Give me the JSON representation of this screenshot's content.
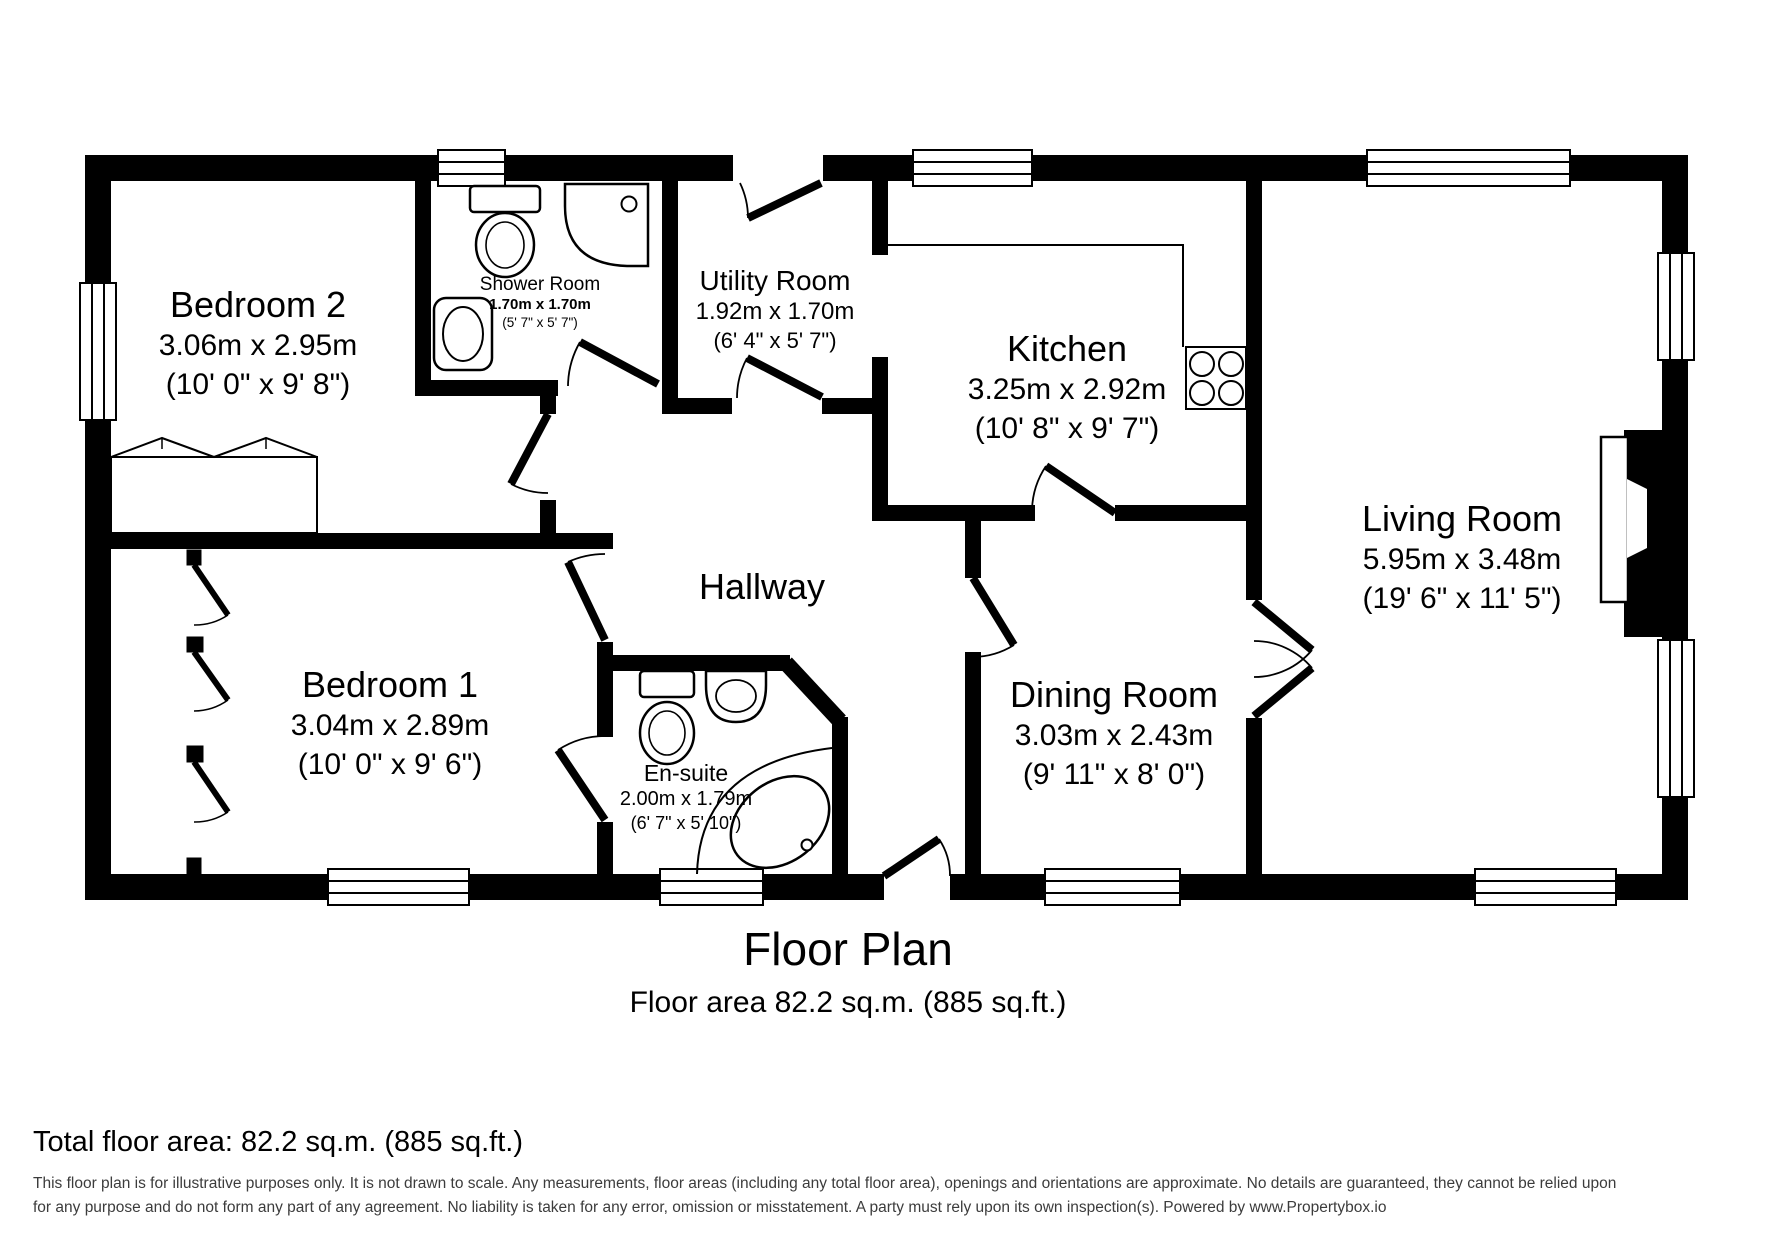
{
  "plan": {
    "title": "Floor Plan",
    "subtitle": "Floor area 82.2 sq.m. (885 sq.ft.)",
    "hallway_label": "Hallway",
    "rooms": {
      "bedroom2": {
        "name": "Bedroom 2",
        "metric": "3.06m x 2.95m",
        "imperial": "(10' 0\" x 9' 8\")"
      },
      "shower": {
        "name": "Shower Room",
        "metric": "1.70m x 1.70m",
        "imperial": "(5' 7\" x 5' 7\")"
      },
      "utility": {
        "name": "Utility Room",
        "metric": "1.92m x 1.70m",
        "imperial": "(6' 4\" x 5' 7\")"
      },
      "kitchen": {
        "name": "Kitchen",
        "metric": "3.25m x 2.92m",
        "imperial": "(10' 8\" x 9' 7\")"
      },
      "living": {
        "name": "Living Room",
        "metric": "5.95m x 3.48m",
        "imperial": "(19' 6\" x 11' 5\")"
      },
      "bedroom1": {
        "name": "Bedroom 1",
        "metric": "3.04m x 2.89m",
        "imperial": "(10' 0\" x 9' 6\")"
      },
      "ensuite": {
        "name": "En-suite",
        "metric": "2.00m x 1.79m",
        "imperial": "(6' 7\" x 5' 10\")"
      },
      "dining": {
        "name": "Dining Room",
        "metric": "3.03m x 2.43m",
        "imperial": "(9' 11\" x 8' 0\")"
      }
    }
  },
  "footer": {
    "total": "Total floor area: 82.2 sq.m. (885 sq.ft.)",
    "disclaimer_line1": "This floor plan is for illustrative purposes only. It is not drawn to scale. Any measurements, floor areas (including any total floor area), openings and orientations are approximate. No details are guaranteed, they cannot be relied upon",
    "disclaimer_line2": "for any purpose and do not form any part of any agreement. No liability is taken for any error, omission or misstatement. A party must rely upon its own inspection(s). Powered by www.Propertybox.io"
  },
  "colors": {
    "wall": "#000000",
    "background": "#ffffff",
    "disclaimer_text": "#3c3c3c"
  }
}
